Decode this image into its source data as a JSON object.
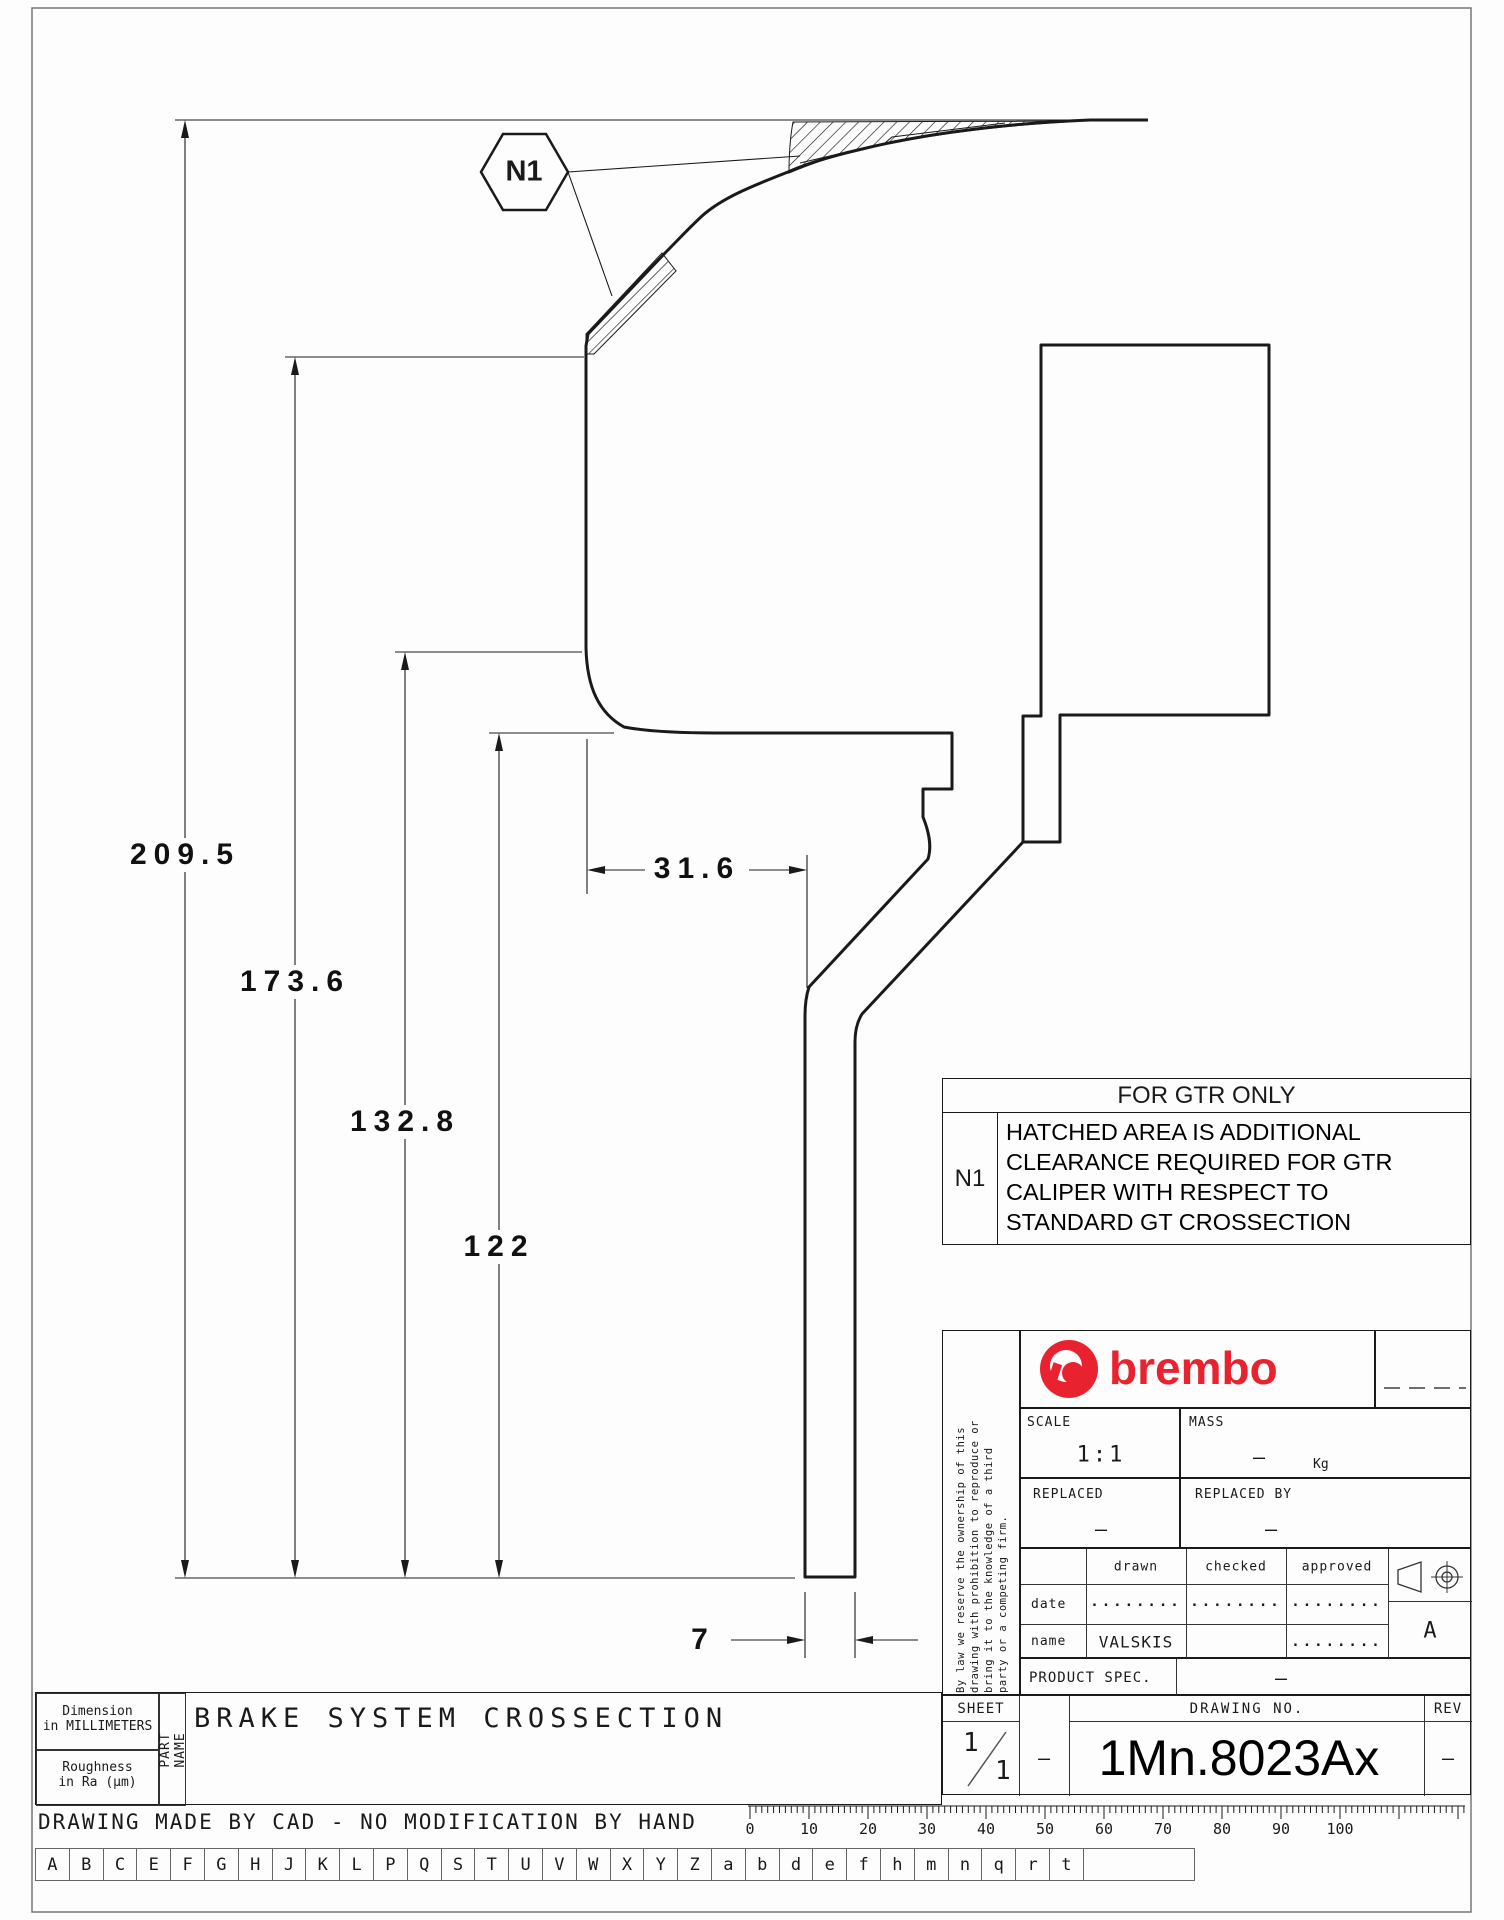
{
  "page": {
    "line_color": "#1a1a1a",
    "brand_color": "#e8232f"
  },
  "callout": {
    "label": "N1"
  },
  "dimensions": {
    "d209": "209.5",
    "d173": "173.6",
    "d132": "132.8",
    "d122": "122",
    "d316": "31.6",
    "d7": "7"
  },
  "note_table": {
    "header": "FOR GTR ONLY",
    "ref": "N1",
    "lines": [
      "HATCHED AREA IS ADDITIONAL",
      "CLEARANCE REQUIRED FOR GTR",
      "CALIPER WITH RESPECT TO",
      "STANDARD GT CROSSECTION"
    ]
  },
  "title_block": {
    "disclaimer_lines": [
      "By law we reserve the ownership of this",
      "drawing with prohibition to reproduce or",
      "bring it to the knowledge of a third",
      "party or a competing firm."
    ],
    "brand": "brembo",
    "scale_label": "SCALE",
    "scale_value": "1:1",
    "mass_label": "MASS",
    "mass_value": "–",
    "mass_unit": "Kg",
    "replaced_label": "REPLACED",
    "replaced_value": "–",
    "replaced_by_label": "REPLACED BY",
    "replaced_by_value": "–",
    "sig_headers": [
      "drawn",
      "checked",
      "approved"
    ],
    "date_label": "date",
    "date_values": [
      "........",
      "........",
      "........"
    ],
    "name_label": "name",
    "name_values": [
      "VALSKIS",
      "",
      "........"
    ],
    "product_spec_label": "PRODUCT SPEC.",
    "product_spec_value": "–",
    "sheet_label": "SHEET",
    "sheet_num": "1",
    "sheet_total": "1",
    "sheet_dash": "–",
    "drawing_no_label": "DRAWING NO.",
    "drawing_no": "1Mn.8023Ax",
    "rev_label": "REV",
    "rev_value": "–",
    "format_letter": "A"
  },
  "footer": {
    "dim_note_l1": "Dimension",
    "dim_note_l2": "in MILLIMETERS",
    "rough_l1": "Roughness",
    "rough_l2": "in Ra (µm)",
    "part_name_label": "PART NAME",
    "part_name": "BRAKE SYSTEM CROSSECTION",
    "cad_note": "DRAWING MADE BY CAD - NO MODIFICATION BY HAND",
    "letters": [
      "A",
      "B",
      "C",
      "E",
      "F",
      "G",
      "H",
      "J",
      "K",
      "L",
      "P",
      "Q",
      "S",
      "T",
      "U",
      "V",
      "W",
      "X",
      "Y",
      "Z",
      "a",
      "b",
      "d",
      "e",
      "f",
      "h",
      "m",
      "n",
      "q",
      "r",
      "t",
      ""
    ],
    "ruler_labels": [
      0,
      10,
      20,
      30,
      40,
      50,
      60,
      70,
      80,
      90,
      100
    ]
  }
}
